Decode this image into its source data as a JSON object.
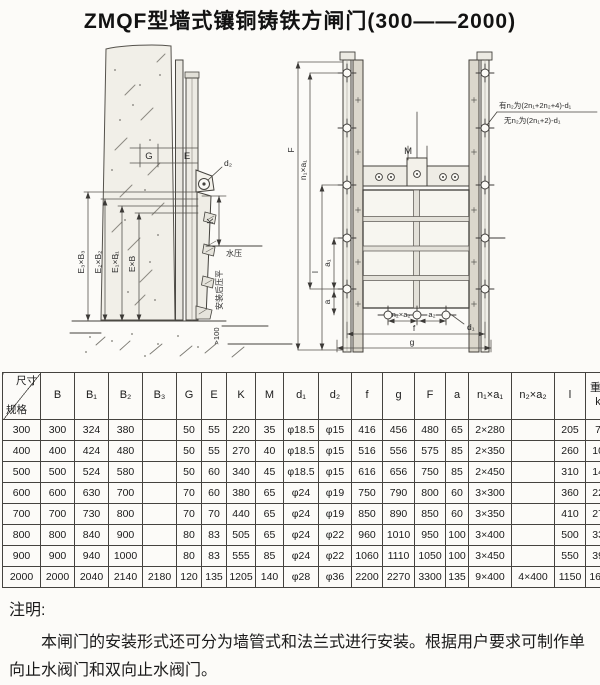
{
  "page": {
    "title": "ZMQF型墙式镶铜铸铁方闸门(300——2000)"
  },
  "side_view": {
    "dim_g": "G",
    "dim_e": "E",
    "dim_d2": "d₂",
    "dim_k": "K",
    "water_pressure": "水压",
    "dim_e3b3": "E₃×B₃",
    "dim_e2b2": "E₂×B₂",
    "dim_e1b1": "E₁×B₁",
    "dim_eb": "E×B",
    "install_note": "安装后压平",
    "min_depth": ">100"
  },
  "front_view": {
    "dim_F": "F",
    "dim_n1a1": "n₁×a₁",
    "dim_l": "l",
    "dim_a1": "a₁",
    "dim_a": "a",
    "dim_M": "M",
    "dim_n2a2": "n₂×a₂",
    "dim_a2": "a₂",
    "dim_d1": "d₁",
    "dim_f": "f",
    "dim_g": "g",
    "note_line1": "有n₂为(2n₁+2n₂+4)-d₁",
    "note_line2": "无n₂为(2n₁+2)-d₁"
  },
  "table": {
    "corner_top": "尺寸",
    "corner_bottom": "规格",
    "headers": [
      "B",
      "B₁",
      "B₂",
      "B₃",
      "G",
      "E",
      "K",
      "M",
      "d₁",
      "d₂",
      "f",
      "g",
      "F",
      "a",
      "n₁×a₁",
      "n₂×a₂",
      "l",
      "重量\nkg"
    ],
    "rows": [
      [
        "300",
        "300",
        "324",
        "380",
        "",
        "50",
        "55",
        "220",
        "35",
        "φ18.5",
        "φ15",
        "416",
        "456",
        "480",
        "65",
        "2×280",
        "",
        "205",
        "70"
      ],
      [
        "400",
        "400",
        "424",
        "480",
        "",
        "50",
        "55",
        "270",
        "40",
        "φ18.5",
        "φ15",
        "516",
        "556",
        "575",
        "85",
        "2×350",
        "",
        "260",
        "107"
      ],
      [
        "500",
        "500",
        "524",
        "580",
        "",
        "50",
        "60",
        "340",
        "45",
        "φ18.5",
        "φ15",
        "616",
        "656",
        "750",
        "85",
        "2×450",
        "",
        "310",
        "145"
      ],
      [
        "600",
        "600",
        "630",
        "700",
        "",
        "70",
        "60",
        "380",
        "65",
        "φ24",
        "φ19",
        "750",
        "790",
        "800",
        "60",
        "3×300",
        "",
        "360",
        "225"
      ],
      [
        "700",
        "700",
        "730",
        "800",
        "",
        "70",
        "70",
        "440",
        "65",
        "φ24",
        "φ19",
        "850",
        "890",
        "850",
        "60",
        "3×350",
        "",
        "410",
        "275"
      ],
      [
        "800",
        "800",
        "840",
        "900",
        "",
        "80",
        "83",
        "505",
        "65",
        "φ24",
        "φ22",
        "960",
        "1010",
        "950",
        "100",
        "3×400",
        "",
        "500",
        "330"
      ],
      [
        "900",
        "900",
        "940",
        "1000",
        "",
        "80",
        "83",
        "555",
        "85",
        "φ24",
        "φ22",
        "1060",
        "1110",
        "1050",
        "100",
        "3×450",
        "",
        "550",
        "393"
      ],
      [
        "2000",
        "2000",
        "2040",
        "2140",
        "2180",
        "120",
        "135",
        "1205",
        "140",
        "φ28",
        "φ36",
        "2200",
        "2270",
        "3300",
        "135",
        "9×400",
        "4×400",
        "1150",
        "1650"
      ]
    ]
  },
  "notes": {
    "heading": "注明:",
    "body": "本闸门的安装形式还可分为墙管式和法兰式进行安装。根据用户要求可制作单向止水阀门和双向止水阀门。"
  }
}
